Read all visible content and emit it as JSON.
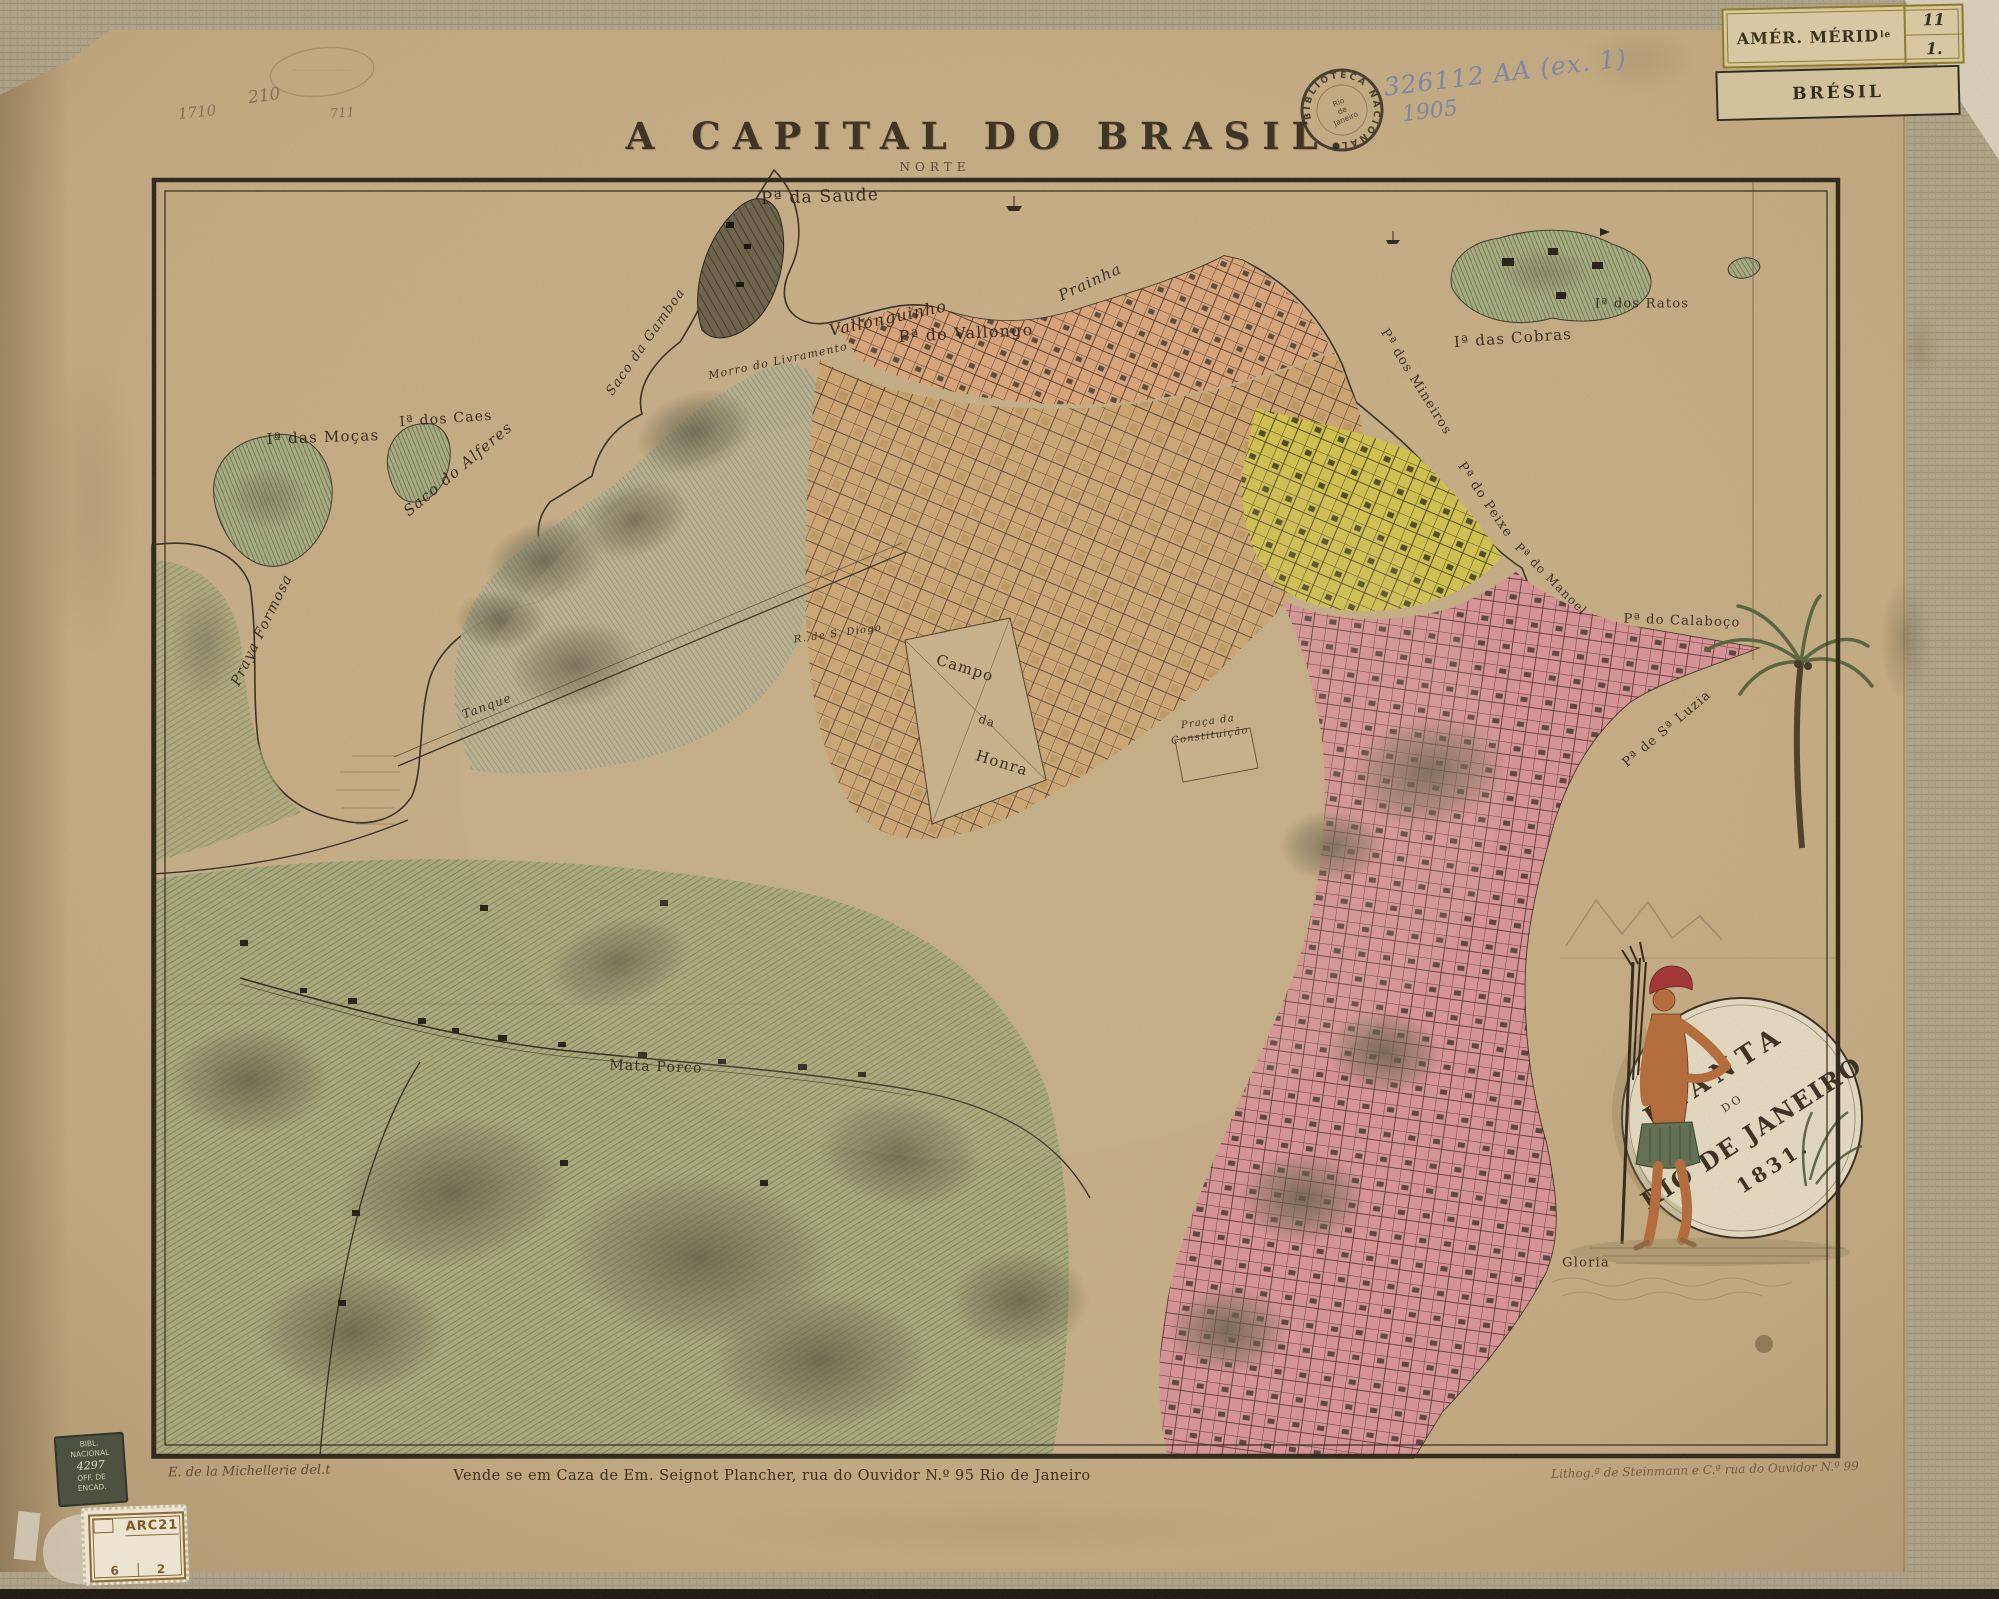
{
  "title_block": {
    "title": "A CAPITAL DO BRASIL.",
    "compass": "NORTE"
  },
  "handwritten": {
    "pencil_a": "210",
    "pencil_b": "1710",
    "pencil_c": "711",
    "call_number": "326112 AA (ex. 1)",
    "year": "1905"
  },
  "stamps": {
    "round_arc": "BIBLIOTECA NACIONAL",
    "round_c1": "Rio",
    "round_c2": "de",
    "round_c3": "Janeiro",
    "shelf_region": "AMÉR. MÉRID",
    "shelf_region_sup": "le",
    "shelf_num_top": "11",
    "shelf_num_bottom": "1.",
    "country": "BRÉSIL",
    "binder": [
      "BIBL.",
      "NACIONAL",
      "4297",
      "OFF. DE",
      "ENCAD."
    ],
    "arc_code": "ARC21",
    "arc_left": "6",
    "arc_right": "2"
  },
  "imprints": {
    "left": "E. de la Michellerie del.t",
    "center": "Vende se em Caza de Em. Seignot Plancher, rua do Ouvidor N.º 95 Rio de Janeiro",
    "right": "Lithog.ª de Steinmann e C.ª rua do Ouvidor N.º 99"
  },
  "cartouche": {
    "l1": "PLANTA",
    "l2": "DO",
    "l3": "RIO DE JANEIRO",
    "l4": "1831."
  },
  "map_labels": [
    {
      "text": "Pª da Saude",
      "x": 820,
      "y": 197,
      "rot": -2,
      "size": 17
    },
    {
      "text": "Vallonguinho",
      "x": 888,
      "y": 318,
      "rot": -12,
      "size": 16,
      "i": 1
    },
    {
      "text": "Pª do Vallongo",
      "x": 966,
      "y": 333,
      "rot": -3,
      "size": 16
    },
    {
      "text": "Prainha",
      "x": 1090,
      "y": 282,
      "rot": -25,
      "size": 15,
      "i": 1
    },
    {
      "text": "Saco da Gamboa",
      "x": 646,
      "y": 342,
      "rot": -55,
      "size": 13,
      "i": 1
    },
    {
      "text": "Morro do Livramento",
      "x": 778,
      "y": 361,
      "rot": -12,
      "size": 11,
      "i": 1
    },
    {
      "text": "Iª das Cobras",
      "x": 1513,
      "y": 338,
      "rot": -4,
      "size": 15
    },
    {
      "text": "Iª dos Ratos",
      "x": 1642,
      "y": 304,
      "rot": 0,
      "size": 13
    },
    {
      "text": "Iª das Moças",
      "x": 323,
      "y": 437,
      "rot": -2,
      "size": 15
    },
    {
      "text": "Iª dos Caes",
      "x": 446,
      "y": 419,
      "rot": -4,
      "size": 14
    },
    {
      "text": "Saco do Alferes",
      "x": 458,
      "y": 469,
      "rot": -40,
      "size": 15,
      "i": 1
    },
    {
      "text": "Praya Formosa",
      "x": 262,
      "y": 630,
      "rot": -64,
      "size": 14,
      "i": 1
    },
    {
      "text": "Pª dos Mineiros",
      "x": 1416,
      "y": 382,
      "rot": 58,
      "size": 13
    },
    {
      "text": "Pª do Peixe",
      "x": 1485,
      "y": 500,
      "rot": 56,
      "size": 13
    },
    {
      "text": "Pª do Manoel",
      "x": 1551,
      "y": 579,
      "rot": 45,
      "size": 12
    },
    {
      "text": "Pª do Calaboço",
      "x": 1682,
      "y": 621,
      "rot": 2,
      "size": 13
    },
    {
      "text": "Pª de Sª Luzia",
      "x": 1667,
      "y": 729,
      "rot": -40,
      "size": 13
    },
    {
      "text": "Campo",
      "x": 965,
      "y": 668,
      "rot": 17,
      "size": 15
    },
    {
      "text": "da",
      "x": 987,
      "y": 721,
      "rot": 17,
      "size": 12
    },
    {
      "text": "Honra",
      "x": 1002,
      "y": 763,
      "rot": 17,
      "size": 15
    },
    {
      "text": "Praça da",
      "x": 1208,
      "y": 722,
      "rot": -8,
      "size": 10,
      "i": 1
    },
    {
      "text": "Constituição",
      "x": 1210,
      "y": 736,
      "rot": -8,
      "size": 10,
      "i": 1
    },
    {
      "text": "R. de S. Diogo",
      "x": 838,
      "y": 634,
      "rot": -8,
      "size": 10,
      "i": 1
    },
    {
      "text": "Tanque",
      "x": 487,
      "y": 706,
      "rot": -20,
      "size": 12,
      "i": 1
    },
    {
      "text": "Mata Porco",
      "x": 656,
      "y": 1067,
      "rot": 2,
      "size": 14
    },
    {
      "text": "Gloria",
      "x": 1586,
      "y": 1263,
      "rot": 0,
      "size": 13
    }
  ],
  "colors": {
    "paper": "#c6ac83",
    "land": "#c9b189",
    "fields": "#a8ac7c",
    "hills": "#b8b596",
    "city": "#d3a671",
    "salmon": "#dfa87d",
    "yellow": "#d7c94b",
    "pink": "#de949b",
    "ink": "#2b2318",
    "stamp_ink": "#2b241b",
    "pencil": "#6f604b",
    "blue_pencil": "#7d87a6"
  }
}
